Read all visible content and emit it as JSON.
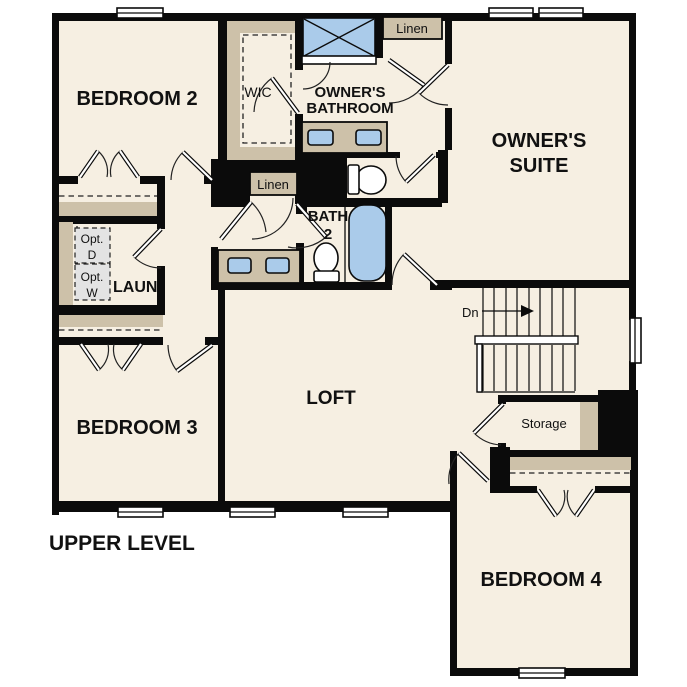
{
  "plan": {
    "level_title": "UPPER LEVEL",
    "rooms": {
      "bedroom2": "BEDROOM 2",
      "bedroom3": "BEDROOM 3",
      "bedroom4": "BEDROOM 4",
      "owners_suite_line1": "OWNER'S",
      "owners_suite_line2": "SUITE",
      "owners_bathroom_line1": "OWNER'S",
      "owners_bathroom_line2": "BATHROOM",
      "bath2_line1": "BATH",
      "bath2_line2": "2",
      "loft": "LOFT",
      "wic": "WIC",
      "laundry": "LAUN",
      "storage": "Storage",
      "linen_upper": "Linen",
      "linen_hall": "Linen"
    },
    "annotations": {
      "stairs_direction": "Dn",
      "opt_dryer_line1": "Opt.",
      "opt_dryer_line2": "D",
      "opt_washer_line1": "Opt.",
      "opt_washer_line2": "W"
    },
    "colors": {
      "background": "#ffffff",
      "floor": "#f6efe2",
      "wall": "#0b0b0b",
      "casework_tan": "#cdc1a9",
      "fixture_blue": "#aacbea",
      "appliance_gray": "#e3e3e3"
    }
  }
}
